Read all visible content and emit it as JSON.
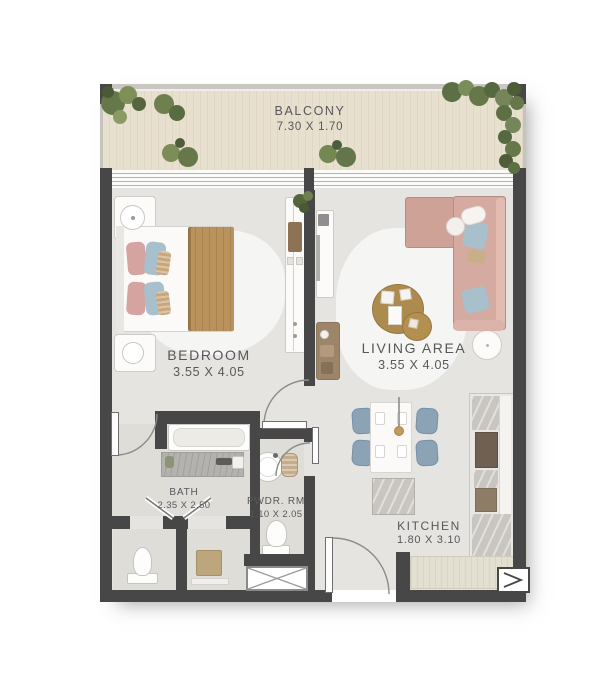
{
  "rooms": {
    "balcony": {
      "name": "BALCONY",
      "dims": "7.30 X 1.70"
    },
    "bedroom": {
      "name": "BEDROOM",
      "dims": "3.55 X 4.05"
    },
    "living_area": {
      "name": "LIVING AREA",
      "dims": "3.55 X 4.05"
    },
    "kitchen": {
      "name": "KITCHEN",
      "dims": "1.80 X 3.10"
    },
    "bath": {
      "name": "BATH",
      "dims": "2.35 X 2.50"
    },
    "powder_room": {
      "name": "PWDR. RM",
      "dims": "1.10 X 2.05"
    }
  },
  "colors": {
    "wall": "#474747",
    "floor": "#e5e4e1",
    "wet_floor": "#dfddd8",
    "balcony_floor": "#e8e0cf",
    "label_text": "#57585a",
    "blanket_tan": "#ba935c",
    "sofa_salmon": "#d5aaa0",
    "pillow_pink": "#d5a4a0",
    "pillow_blue": "#a8bfcc",
    "chair_blue": "#8ba3b5",
    "table_wood": "#ad8a4e",
    "console_wood": "#9c8569",
    "counter_beige": "#e4e0d1",
    "plant_green": "#66784a"
  }
}
